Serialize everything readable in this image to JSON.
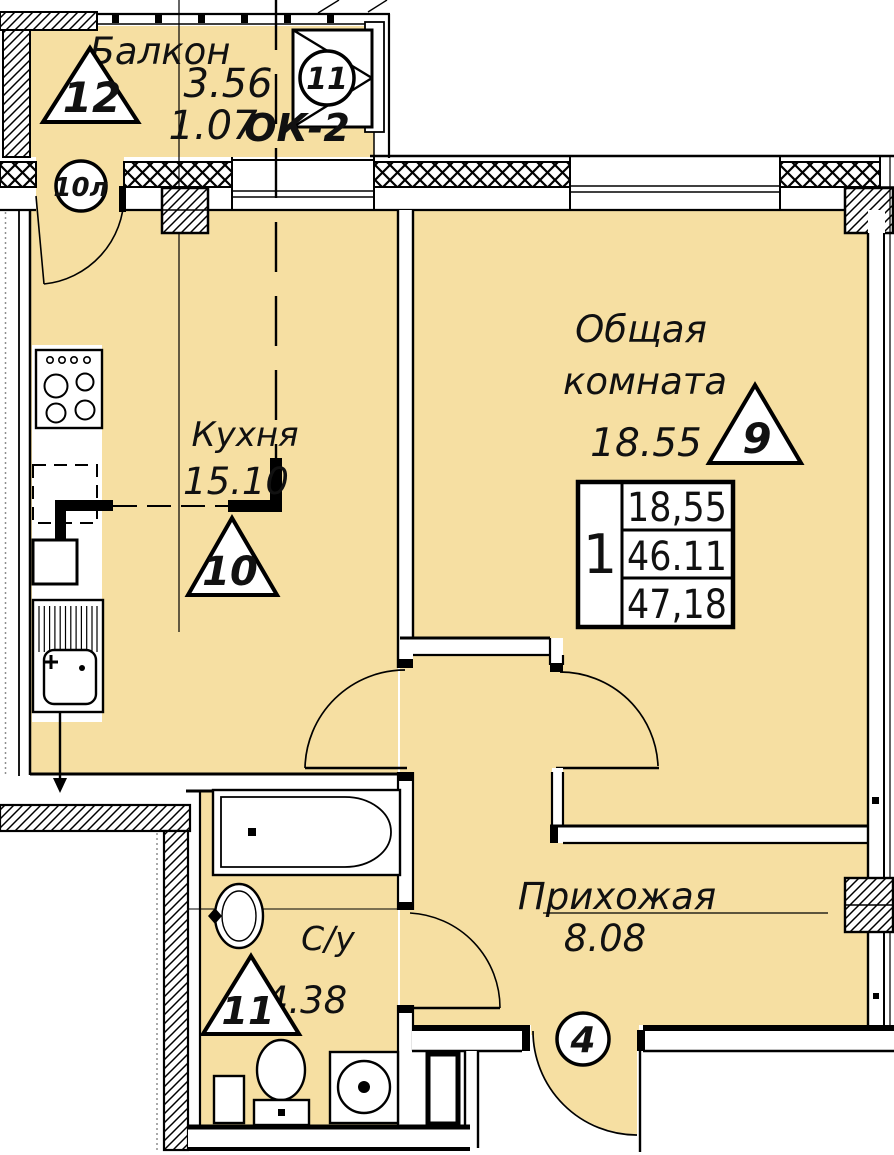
{
  "colors": {
    "floor": "#F6DFA2",
    "line": "#000000",
    "insulation_dots": "#8f8f8f"
  },
  "balcony": {
    "name": "Балкон",
    "area_top": "3.56",
    "area_bottom": "1.07",
    "window_label": "ОК-2",
    "triangle_marker": "12",
    "window_circle_marker": "11",
    "door_circle_marker": "10л"
  },
  "kitchen": {
    "name": "Кухня",
    "area": "15.10",
    "triangle_marker": "10"
  },
  "living": {
    "name_line1": "Общая",
    "name_line2": "комната",
    "area": "18.55",
    "triangle_marker": "9"
  },
  "hall": {
    "name": "Прихожая",
    "area": "8.08",
    "entry_circle_marker": "4"
  },
  "bath": {
    "name": "С/у",
    "area": "4.38",
    "triangle_marker": "11"
  },
  "stamp": {
    "rooms": "1",
    "living_area": "18,55",
    "apartment_area": "46.11",
    "total_area": "47,18"
  }
}
